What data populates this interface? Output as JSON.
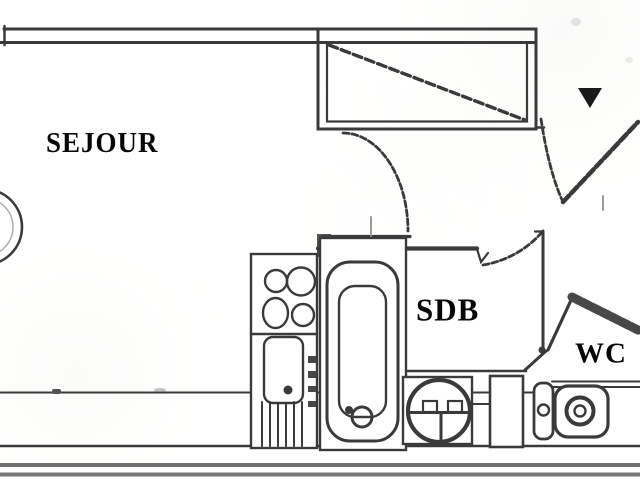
{
  "plan": {
    "type": "apartment-floor-plan",
    "style": "scanned black-and-white architectural drawing"
  },
  "rooms": [
    {
      "id": "sejour",
      "label": "SEJOUR"
    },
    {
      "id": "sdb",
      "label": "SDB"
    },
    {
      "id": "wc",
      "label": "WC"
    }
  ],
  "symbols": [
    "closet-icon",
    "entrance-arrow-icon",
    "entry-door-icon",
    "interior-door-icon",
    "sdb-door-icon",
    "kitchen-hob-icon",
    "kitchen-sink-icon",
    "bathtub-icon",
    "washbasin-icon",
    "shower-door-icon",
    "toilet-cistern-icon",
    "toilet-bowl-icon",
    "round-table-icon",
    "hatched-wall-icon"
  ],
  "colors": {
    "ink": "#3e3e3e",
    "wall_gray": "#6f6f6f",
    "paper": "#fcfcfb",
    "label_ink": "#0d0d0d",
    "arrow_fill": "#1f1f1f"
  }
}
